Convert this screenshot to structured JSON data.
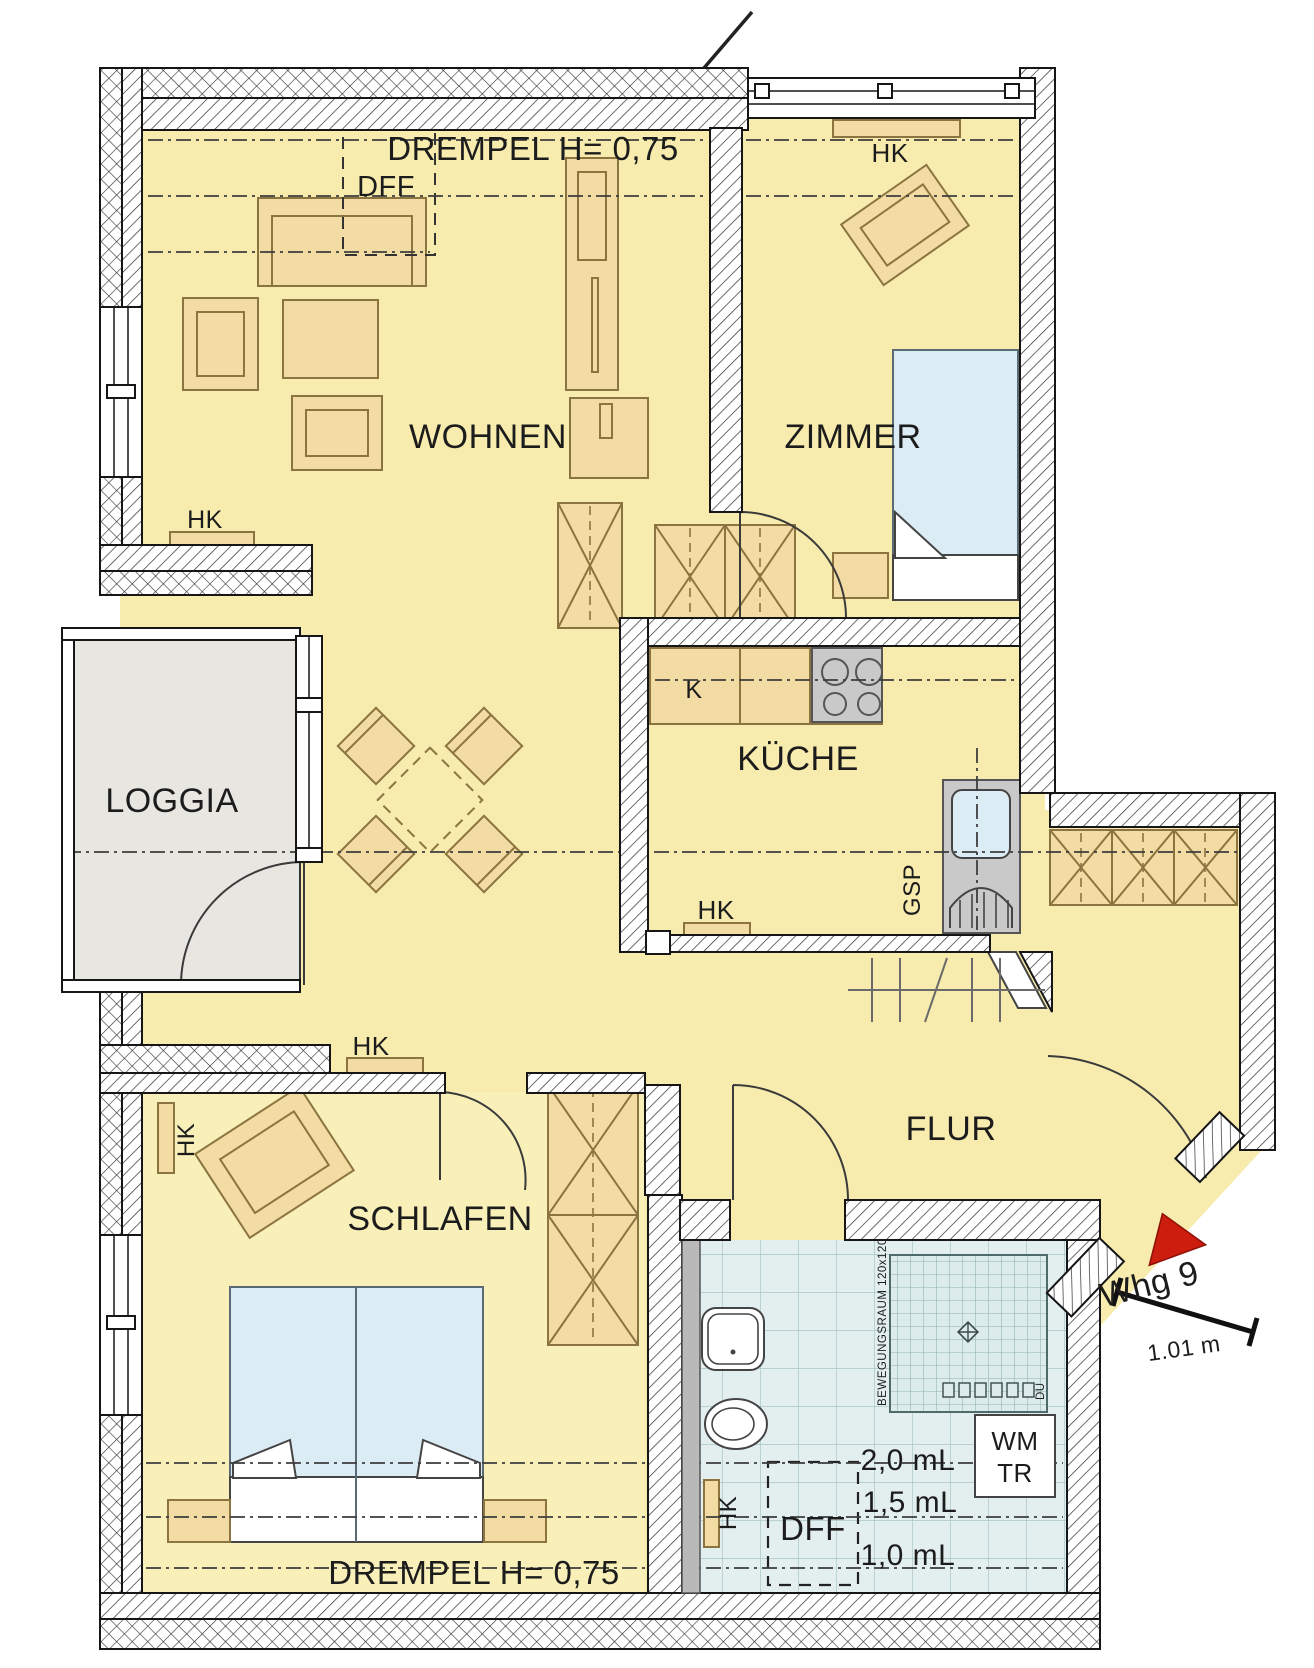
{
  "rooms": {
    "wohnen": "WOHNEN",
    "zimmer": "ZIMMER",
    "kueche": "KÜCHE",
    "flur": "FLUR",
    "schlafen": "SCHLAFEN",
    "loggia": "LOGGIA"
  },
  "annotations": {
    "drempel": "DREMPEL H= 0,75",
    "dff": "DFF",
    "hk": "HK",
    "fridge": "K",
    "gsp": "GSP",
    "wm": "WM",
    "tr": "TR",
    "apartment": "Whg 9",
    "door_width": "1.01 m",
    "h20": "2,0 mL",
    "h15": "1,5 mL",
    "h10": "1,0 mL",
    "movement": "BEWEGUNGSRAUM 120x120",
    "du": "DU"
  },
  "colors": {
    "room_yellow": "#f7ecae",
    "bedroom_yellow": "#f8efb9",
    "furniture": "#f3dba4",
    "furniture_line": "#8b7440",
    "loggia_gray": "#e8e6e1",
    "tile_bg": "#e3eeee",
    "tile_line": "#a9c6c6",
    "appliance_gray": "#c9c9c9",
    "bed_blue": "#dcecf4",
    "arrow_red": "#cc1d0f",
    "wall_line": "#111111"
  }
}
